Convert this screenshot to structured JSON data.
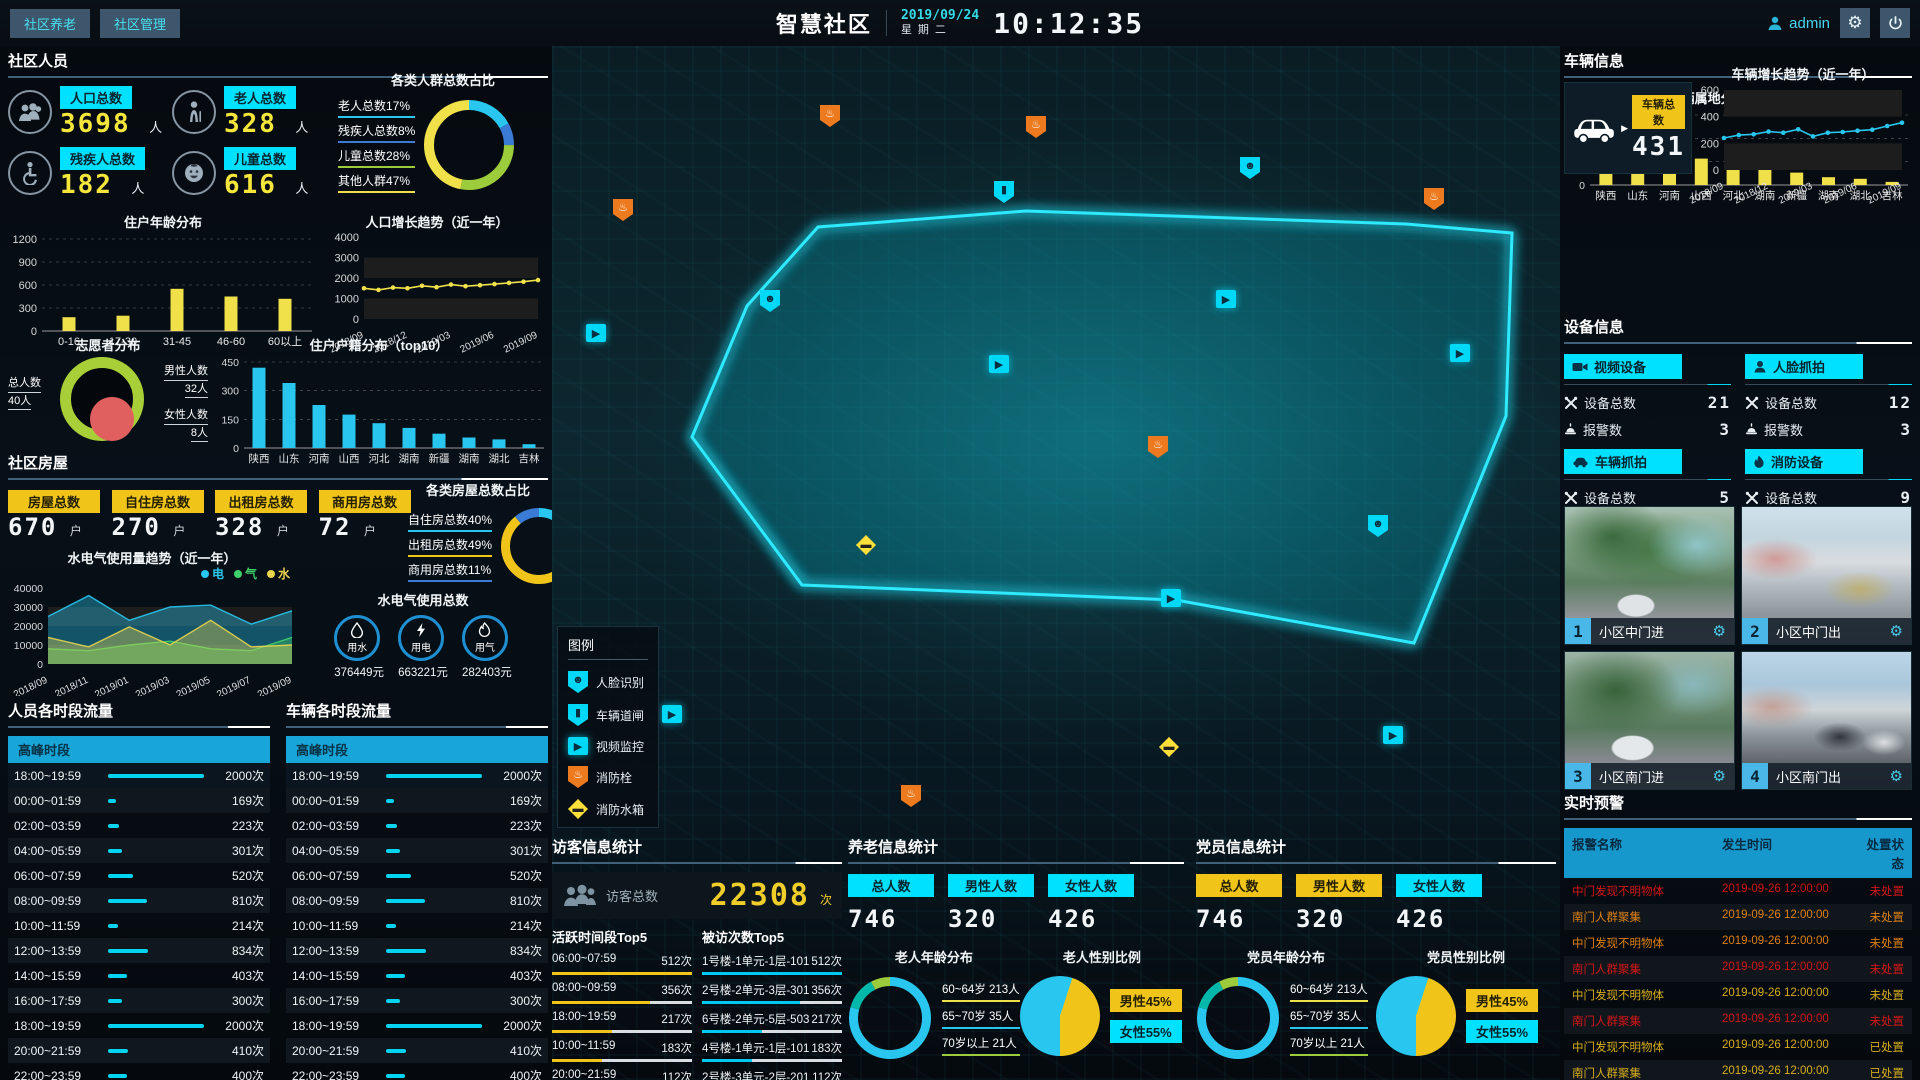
{
  "header": {
    "nav": [
      {
        "label": "社区养老"
      },
      {
        "label": "社区管理"
      }
    ],
    "title": "智慧社区",
    "date": "2019/09/24",
    "weekday": "星期二",
    "time": "10:12:35",
    "user": "admin"
  },
  "people": {
    "title": "社区人员",
    "stats": [
      {
        "icon": "population-icon",
        "label": "人口总数",
        "value": "3698",
        "unit": "人"
      },
      {
        "icon": "elderly-icon",
        "label": "老人总数",
        "value": "328",
        "unit": "人"
      },
      {
        "icon": "disabled-icon",
        "label": "残疾人总数",
        "value": "182",
        "unit": "人"
      },
      {
        "icon": "children-icon",
        "label": "儿童总数",
        "value": "616",
        "unit": "人"
      }
    ],
    "ratio_title": "各类人群总数占比",
    "age_title": "住户年龄分布",
    "growth_title": "人口增长趋势（近一年）",
    "volunteer": {
      "title": "志愿者分布",
      "total_label": "总人数",
      "total": "40人",
      "male_label": "男性人数",
      "male": "32人",
      "female_label": "女性人数",
      "female": "8人"
    },
    "census_title": "住户户籍分布（top10）"
  },
  "house": {
    "title": "社区房屋",
    "stats": [
      {
        "label": "房屋总数",
        "value": "670",
        "unit": "户"
      },
      {
        "label": "自住房总数",
        "value": "270",
        "unit": "户"
      },
      {
        "label": "出租房总数",
        "value": "328",
        "unit": "户"
      },
      {
        "label": "商用房总数",
        "value": "72",
        "unit": "户"
      }
    ],
    "trend_title": "水电气使用量趋势（近一年）",
    "ratio_title": "各类房屋总数占比",
    "usage_title": "水电气使用总数",
    "usage": [
      {
        "icon": "water-icon",
        "label": "用水",
        "value": "376449元"
      },
      {
        "icon": "electric-icon",
        "label": "用电",
        "value": "663221元"
      },
      {
        "icon": "gas-icon",
        "label": "用气",
        "value": "282403元"
      }
    ]
  },
  "people_flow": {
    "title": "人员各时段流量",
    "peak_label": "高峰时段",
    "unit": "次",
    "rows": [
      {
        "time": "18:00~19:59",
        "count": 2000,
        "peak": true
      },
      {
        "time": "00:00~01:59",
        "count": 169
      },
      {
        "time": "02:00~03:59",
        "count": 223
      },
      {
        "time": "04:00~05:59",
        "count": 301
      },
      {
        "time": "06:00~07:59",
        "count": 520
      },
      {
        "time": "08:00~09:59",
        "count": 810
      },
      {
        "time": "10:00~11:59",
        "count": 214
      },
      {
        "time": "12:00~13:59",
        "count": 834
      },
      {
        "time": "14:00~15:59",
        "count": 403
      },
      {
        "time": "16:00~17:59",
        "count": 300
      },
      {
        "time": "18:00~19:59",
        "count": 2000
      },
      {
        "time": "20:00~21:59",
        "count": 410
      },
      {
        "time": "22:00~23:59",
        "count": 400
      }
    ]
  },
  "vehicle_flow": {
    "title": "车辆各时段流量",
    "peak_label": "高峰时段",
    "unit": "次",
    "rows": [
      {
        "time": "18:00~19:59",
        "count": 2000,
        "peak": true
      },
      {
        "time": "00:00~01:59",
        "count": 169
      },
      {
        "time": "02:00~03:59",
        "count": 223
      },
      {
        "time": "04:00~05:59",
        "count": 301
      },
      {
        "time": "06:00~07:59",
        "count": 520
      },
      {
        "time": "08:00~09:59",
        "count": 810
      },
      {
        "time": "10:00~11:59",
        "count": 214
      },
      {
        "time": "12:00~13:59",
        "count": 834
      },
      {
        "time": "14:00~15:59",
        "count": 403
      },
      {
        "time": "16:00~17:59",
        "count": 300
      },
      {
        "time": "18:00~19:59",
        "count": 2000
      },
      {
        "time": "20:00~21:59",
        "count": 410
      },
      {
        "time": "22:00~23:59",
        "count": 400
      }
    ]
  },
  "map": {
    "legend": {
      "title": "图例",
      "items": [
        {
          "icon": "face-recognition-marker",
          "label": "人脸识别",
          "type": "face"
        },
        {
          "icon": "vehicle-gate-marker",
          "label": "车辆道闸",
          "type": "gate"
        },
        {
          "icon": "video-monitor-marker",
          "label": "视频监控",
          "type": "video"
        },
        {
          "icon": "fire-hydrant-marker",
          "label": "消防栓",
          "type": "hydrant"
        },
        {
          "icon": "fire-tank-marker",
          "label": "消防水箱",
          "type": "tank"
        }
      ]
    },
    "markers": [
      {
        "type": "hydrant",
        "x": 268,
        "y": 59
      },
      {
        "type": "hydrant",
        "x": 474,
        "y": 70
      },
      {
        "type": "face",
        "x": 688,
        "y": 111
      },
      {
        "type": "gate",
        "x": 442,
        "y": 135
      },
      {
        "type": "hydrant",
        "x": 872,
        "y": 142
      },
      {
        "type": "hydrant",
        "x": 61,
        "y": 153
      },
      {
        "type": "face",
        "x": 208,
        "y": 244
      },
      {
        "type": "video",
        "x": 664,
        "y": 244
      },
      {
        "type": "video",
        "x": 34,
        "y": 278
      },
      {
        "type": "video",
        "x": 898,
        "y": 298
      },
      {
        "type": "video",
        "x": 437,
        "y": 309
      },
      {
        "type": "hydrant",
        "x": 596,
        "y": 390
      },
      {
        "type": "face",
        "x": 816,
        "y": 469
      },
      {
        "type": "tank",
        "x": 304,
        "y": 489
      },
      {
        "type": "video",
        "x": 609,
        "y": 543
      },
      {
        "type": "video",
        "x": 110,
        "y": 659
      },
      {
        "type": "video",
        "x": 831,
        "y": 680
      },
      {
        "type": "tank",
        "x": 607,
        "y": 691
      },
      {
        "type": "hydrant",
        "x": 349,
        "y": 739
      }
    ]
  },
  "visitor": {
    "title": "访客信息统计",
    "total_label": "访客总数",
    "total": "22308",
    "total_unit": "次",
    "active_title": "活跃时间段Top5",
    "active": [
      {
        "label": "06:00~07:59",
        "value": "512次",
        "pct": 100
      },
      {
        "label": "08:00~09:59",
        "value": "356次",
        "pct": 70
      },
      {
        "label": "18:00~19:59",
        "value": "217次",
        "pct": 43
      },
      {
        "label": "10:00~11:59",
        "value": "183次",
        "pct": 36
      },
      {
        "label": "20:00~21:59",
        "value": "112次",
        "pct": 22
      }
    ],
    "visited_title": "被访次数Top5",
    "visited": [
      {
        "label": "1号楼-1单元-1层-101",
        "value": "512次",
        "pct": 100
      },
      {
        "label": "2号楼-2单元-3层-301",
        "value": "356次",
        "pct": 70
      },
      {
        "label": "6号楼-2单元-5层-503",
        "value": "217次",
        "pct": 43
      },
      {
        "label": "4号楼-1单元-1层-101",
        "value": "183次",
        "pct": 36
      },
      {
        "label": "2号楼-3单元-2层-201",
        "value": "112次",
        "pct": 22
      }
    ]
  },
  "elder": {
    "title": "养老信息统计",
    "stats": [
      {
        "label": "总人数",
        "value": "746",
        "style": "cyan"
      },
      {
        "label": "男性人数",
        "value": "320",
        "style": "cyan"
      },
      {
        "label": "女性人数",
        "value": "426",
        "style": "cyan"
      }
    ],
    "age_title": "老人年龄分布",
    "age_items": [
      {
        "label": "60~64岁 213人",
        "color": "#f0e04a"
      },
      {
        "label": "65~70岁 35人",
        "color": "#29c7ef"
      },
      {
        "label": "70岁以上 21人",
        "color": "#9ccb3c"
      }
    ],
    "gender_title": "老人性别比例",
    "gender_labels": [
      {
        "label": "男性45%",
        "style": "yellow"
      },
      {
        "label": "女性55%",
        "style": "cyan"
      }
    ]
  },
  "party": {
    "title": "党员信息统计",
    "stats": [
      {
        "label": "总人数",
        "value": "746",
        "style": "yellow"
      },
      {
        "label": "男性人数",
        "value": "320",
        "style": "yellow"
      },
      {
        "label": "女性人数",
        "value": "426",
        "style": "cyan"
      }
    ],
    "age_title": "党员年龄分布",
    "age_items": [
      {
        "label": "60~64岁 213人",
        "color": "#f0e04a"
      },
      {
        "label": "65~70岁 35人",
        "color": "#29c7ef"
      },
      {
        "label": "70岁以上 21人",
        "color": "#9ccb3c"
      }
    ],
    "gender_title": "党员性别比例",
    "gender_labels": [
      {
        "label": "男性45%",
        "style": "yellow"
      },
      {
        "label": "女性55%",
        "style": "cyan"
      }
    ]
  },
  "vehicle_info": {
    "title": "车辆信息",
    "total_label": "车辆总数",
    "total": "431",
    "growth_title": "车辆增长趋势（近一年）",
    "origin_title": "车辆属地分布（top10）"
  },
  "device": {
    "title": "设备信息",
    "total_label": "设备总数",
    "alarm_label": "报警数",
    "cards": [
      {
        "icon": "video-device-icon",
        "name": "视频设备",
        "total": "21",
        "alarm": "3"
      },
      {
        "icon": "face-capture-icon",
        "name": "人脸抓拍",
        "total": "12",
        "alarm": "3"
      },
      {
        "icon": "vehicle-capture-icon",
        "name": "车辆抓拍",
        "total": "5",
        "alarm": "3"
      },
      {
        "icon": "fire-device-icon",
        "name": "消防设备",
        "total": "9",
        "alarm": "3"
      }
    ]
  },
  "cameras": [
    {
      "num": "1",
      "label": "小区中门进",
      "scene": "scene1"
    },
    {
      "num": "2",
      "label": "小区中门出",
      "scene": "scene2"
    },
    {
      "num": "3",
      "label": "小区南门进",
      "scene": "scene3"
    },
    {
      "num": "4",
      "label": "小区南门出",
      "scene": "scene4"
    }
  ],
  "alerts": {
    "title": "实时预警",
    "columns": [
      "报警名称",
      "发生时间",
      "处置状态"
    ],
    "rows": [
      {
        "name": "中门发现不明物体",
        "time": "2019-09-26 12:00:00",
        "status": "未处置",
        "color": "red"
      },
      {
        "name": "南门人群聚集",
        "time": "2019-09-26 12:00:00",
        "status": "未处置",
        "color": "orange"
      },
      {
        "name": "中门发现不明物体",
        "time": "2019-09-26 12:00:00",
        "status": "未处置",
        "color": "orange"
      },
      {
        "name": "南门人群聚集",
        "time": "2019-09-26 12:00:00",
        "status": "未处置",
        "color": "red"
      },
      {
        "name": "中门发现不明物体",
        "time": "2019-09-26 12:00:00",
        "status": "未处置",
        "color": "gold"
      },
      {
        "name": "南门人群聚集",
        "time": "2019-09-26 12:00:00",
        "status": "未处置",
        "color": "red"
      },
      {
        "name": "中门发现不明物体",
        "time": "2019-09-26 12:00:00",
        "status": "已处置",
        "color": "gold"
      },
      {
        "name": "南门人群聚集",
        "time": "2019-09-26 12:00:00",
        "status": "已处置",
        "color": "gold"
      },
      {
        "name": "南门京PH3X00车辆...",
        "time": "2019-09-26 12:00:00",
        "status": "已处置",
        "color": "gold"
      }
    ]
  },
  "chart_data": [
    {
      "id": "crowd_ratio",
      "type": "pie",
      "donut": true,
      "title": "各类人群总数占比",
      "labels": [
        "老人总数",
        "残疾人总数",
        "儿童总数",
        "其他人群"
      ],
      "values": [
        17,
        8,
        28,
        47
      ],
      "unit": "%",
      "colors": [
        "#29c7ef",
        "#3a7bd5",
        "#9ccb3c",
        "#f0e04a"
      ]
    },
    {
      "id": "resident_age",
      "type": "bar",
      "title": "住户年龄分布",
      "categories": [
        "0-16",
        "17-30",
        "31-45",
        "46-60",
        "60以上"
      ],
      "values": [
        180,
        200,
        550,
        450,
        420
      ],
      "ylim": [
        0,
        1200
      ],
      "yticks": [
        0,
        300,
        600,
        900,
        1200
      ],
      "color": "#f0e04a"
    },
    {
      "id": "population_growth",
      "type": "line",
      "title": "人口增长趋势（近一年）",
      "x": [
        "2018/09",
        "2018/12",
        "2019/03",
        "2019/06",
        "2019/09"
      ],
      "values": [
        1500,
        1420,
        1530,
        1500,
        1620,
        1550,
        1680,
        1600,
        1650,
        1700,
        1760,
        1820,
        1900
      ],
      "ylim": [
        0,
        4000
      ],
      "yticks": [
        0,
        1000,
        2000,
        3000,
        4000
      ],
      "color": "#f0e04a"
    },
    {
      "id": "census_top10",
      "type": "bar",
      "title": "住户户籍分布（top10）",
      "categories": [
        "陕西",
        "山东",
        "河南",
        "山西",
        "河北",
        "湖南",
        "新疆",
        "湖南",
        "湖北",
        "吉林"
      ],
      "values": [
        420,
        340,
        225,
        175,
        130,
        105,
        75,
        55,
        45,
        20
      ],
      "ylim": [
        0,
        450
      ],
      "yticks": [
        0,
        150,
        300,
        450
      ],
      "color": "#29c7ef"
    },
    {
      "id": "utility_trend",
      "type": "area",
      "title": "水电气使用量趋势（近一年）",
      "x": [
        "2018/09",
        "2018/11",
        "2019/01",
        "2019/03",
        "2019/05",
        "2019/07",
        "2019/09"
      ],
      "series": [
        {
          "name": "电",
          "color": "#29c7ef",
          "values": [
            25000,
            36000,
            23000,
            30000,
            31000,
            21000,
            28000
          ]
        },
        {
          "name": "气",
          "color": "#3fd06a",
          "values": [
            8000,
            7000,
            10000,
            12000,
            8000,
            7000,
            14000
          ]
        },
        {
          "name": "水",
          "color": "#e8d44d",
          "values": [
            14000,
            9000,
            19500,
            10000,
            23000,
            9000,
            10000
          ]
        }
      ],
      "ylim": [
        0,
        40000
      ],
      "yticks": [
        0,
        10000,
        20000,
        30000,
        40000
      ]
    },
    {
      "id": "house_ratio",
      "type": "pie",
      "donut": true,
      "title": "各类房屋总数占比",
      "labels": [
        "自住房总数",
        "出租房总数",
        "商用房总数"
      ],
      "values": [
        40,
        49,
        11
      ],
      "unit": "%",
      "colors": [
        "#29c7ef",
        "#f0c419",
        "#3a7bd5"
      ]
    },
    {
      "id": "vehicle_growth",
      "type": "line",
      "title": "车辆增长趋势（近一年）",
      "x": [
        "2018/09",
        "2018/12",
        "2019/03",
        "2019/06",
        "2019/09"
      ],
      "values": [
        240,
        262,
        268,
        288,
        280,
        305,
        252,
        280,
        285,
        295,
        302,
        330,
        355
      ],
      "ylim": [
        0,
        600
      ],
      "yticks": [
        0,
        200,
        400,
        600
      ],
      "color": "#29c7ef"
    },
    {
      "id": "vehicle_origin",
      "type": "bar",
      "title": "车辆属地分布（top10）",
      "categories": [
        "陕西",
        "山东",
        "河南",
        "山西",
        "河北",
        "湖南",
        "新疆",
        "湖南",
        "湖北",
        "吉林"
      ],
      "values": [
        38,
        33,
        21,
        17,
        13,
        10,
        8,
        5,
        4,
        2
      ],
      "ylim": [
        0,
        45
      ],
      "yticks": [
        0,
        15,
        30,
        45
      ],
      "color": "#f0e04a"
    },
    {
      "id": "elder_age",
      "type": "pie",
      "donut": true,
      "title": "老人年龄分布",
      "labels": [
        "60~64岁",
        "65~70岁",
        "70岁以上"
      ],
      "values": [
        213,
        35,
        21
      ],
      "unit": "人",
      "colors": [
        "#29c7ef",
        "#00b8a9",
        "#9ccb3c"
      ]
    },
    {
      "id": "elder_gender",
      "type": "pie",
      "title": "老人性别比例",
      "labels": [
        "男性",
        "女性"
      ],
      "values": [
        45,
        55
      ],
      "unit": "%",
      "colors": [
        "#f0c419",
        "#29c7ef"
      ]
    },
    {
      "id": "party_age",
      "type": "pie",
      "donut": true,
      "title": "党员年龄分布",
      "labels": [
        "60~64岁",
        "65~70岁",
        "70岁以上"
      ],
      "values": [
        213,
        35,
        21
      ],
      "unit": "人",
      "colors": [
        "#29c7ef",
        "#00b8a9",
        "#9ccb3c"
      ]
    },
    {
      "id": "party_gender",
      "type": "pie",
      "title": "党员性别比例",
      "labels": [
        "男性",
        "女性"
      ],
      "values": [
        45,
        55
      ],
      "unit": "%",
      "colors": [
        "#f0c419",
        "#29c7ef"
      ]
    },
    {
      "id": "volunteer",
      "type": "pie",
      "donut": true,
      "title": "志愿者分布",
      "labels": [
        "总人数",
        "男性人数",
        "女性人数"
      ],
      "values": [
        40,
        32,
        8
      ],
      "unit": "人",
      "colors": [
        "#a8ce38",
        "#a8ce38",
        "#e05f5f"
      ]
    }
  ]
}
